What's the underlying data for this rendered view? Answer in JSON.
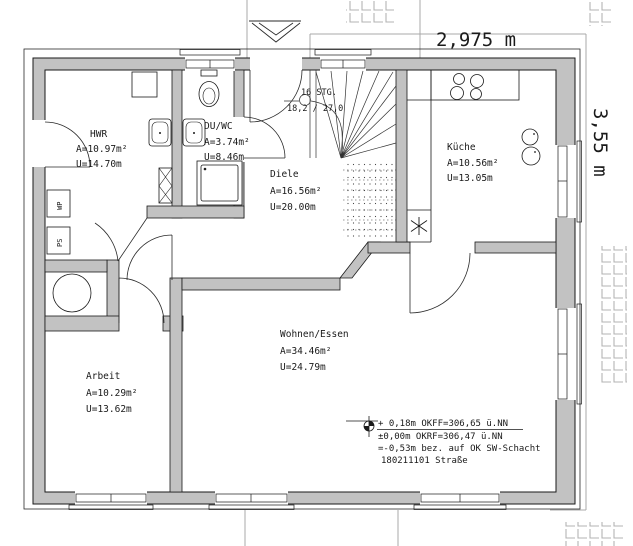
{
  "plan": {
    "rooms": [
      {
        "id": "hwr",
        "name": "HWR",
        "area": "A=10.97m²",
        "perimeter": "U=14.70m"
      },
      {
        "id": "duwc",
        "name": "DU/WC",
        "area": "A=3.74m²",
        "perimeter": "U=8.46m"
      },
      {
        "id": "diele",
        "name": "Diele",
        "area": "A=16.56m²",
        "perimeter": "U=20.00m"
      },
      {
        "id": "kueche",
        "name": "Küche",
        "area": "A=10.56m²",
        "perimeter": "U=13.05m"
      },
      {
        "id": "arbeit",
        "name": "Arbeit",
        "area": "A=10.29m²",
        "perimeter": "U=13.62m"
      },
      {
        "id": "wohnen",
        "name": "Wohnen/Essen",
        "area": "A=34.46m²",
        "perimeter": "U=24.79m"
      }
    ],
    "stairs": {
      "count": "16 STG.",
      "ratio": "18,2 / 27,0"
    },
    "dimensions": {
      "top": "2,975 m",
      "right": "3,55 m"
    },
    "levels": {
      "l1": "+ 0,18m OKFF=306,65 ü.NN",
      "l2": "±0,00m OKRF=306,47 ü.NN",
      "l3": "=-0,53m bez. auf OK SW-Schacht",
      "l4": "180211101 Straße"
    },
    "equipment": {
      "wp": "WP",
      "ps": "PS"
    },
    "colors": {
      "wall": "#c2c2c2",
      "line": "#1a1a1a",
      "dim": "#a9a9a9",
      "tile": "#b3b3b3"
    }
  }
}
